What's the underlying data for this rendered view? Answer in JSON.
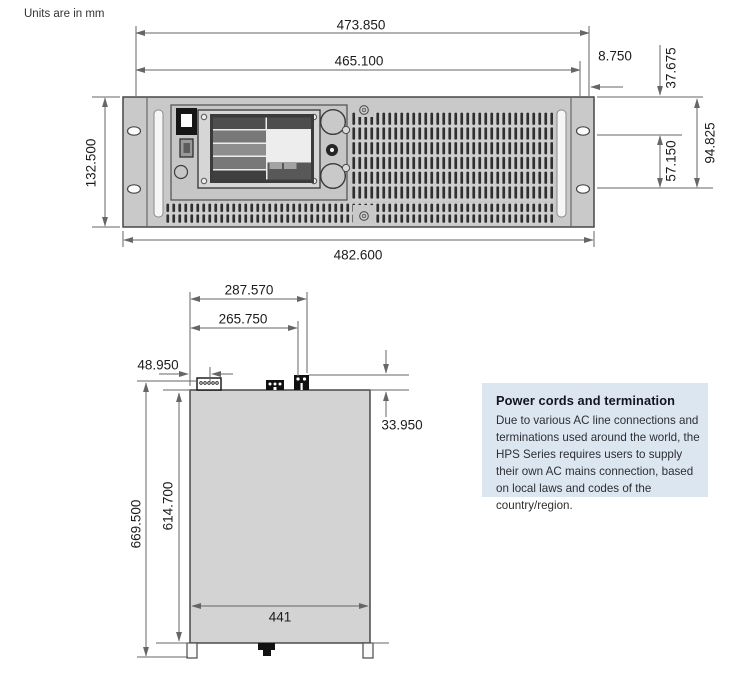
{
  "units_note": "Units are in mm",
  "front_view": {
    "dims": {
      "width_upper": "473.850",
      "width_inner": "465.100",
      "right_offset": "8.750",
      "panel_height": "132.500",
      "hole_top_offset": "37.675",
      "hole_spacing": "57.150",
      "hole_span": "94.825",
      "width_overall": "482.600"
    }
  },
  "side_view": {
    "dims": {
      "connector_outer": "287.570",
      "connector_inner": "265.750",
      "connector_left_offset": "48.950",
      "connector_height": "33.950",
      "height_overall": "669.500",
      "body_height": "614.700",
      "inner_width": "441"
    }
  },
  "info_box": {
    "title": "Power cords and termination",
    "body": "Due to various AC line connections and terminations used around the world, the HPS Series requires users to supply their own AC mains connection, based on local laws and codes of the country/region.",
    "bg_color": "#dce6f0"
  },
  "colors": {
    "chassis": "#c9c9c9",
    "dimension_line": "#666666",
    "vent_slot": "#2f2f2f"
  }
}
